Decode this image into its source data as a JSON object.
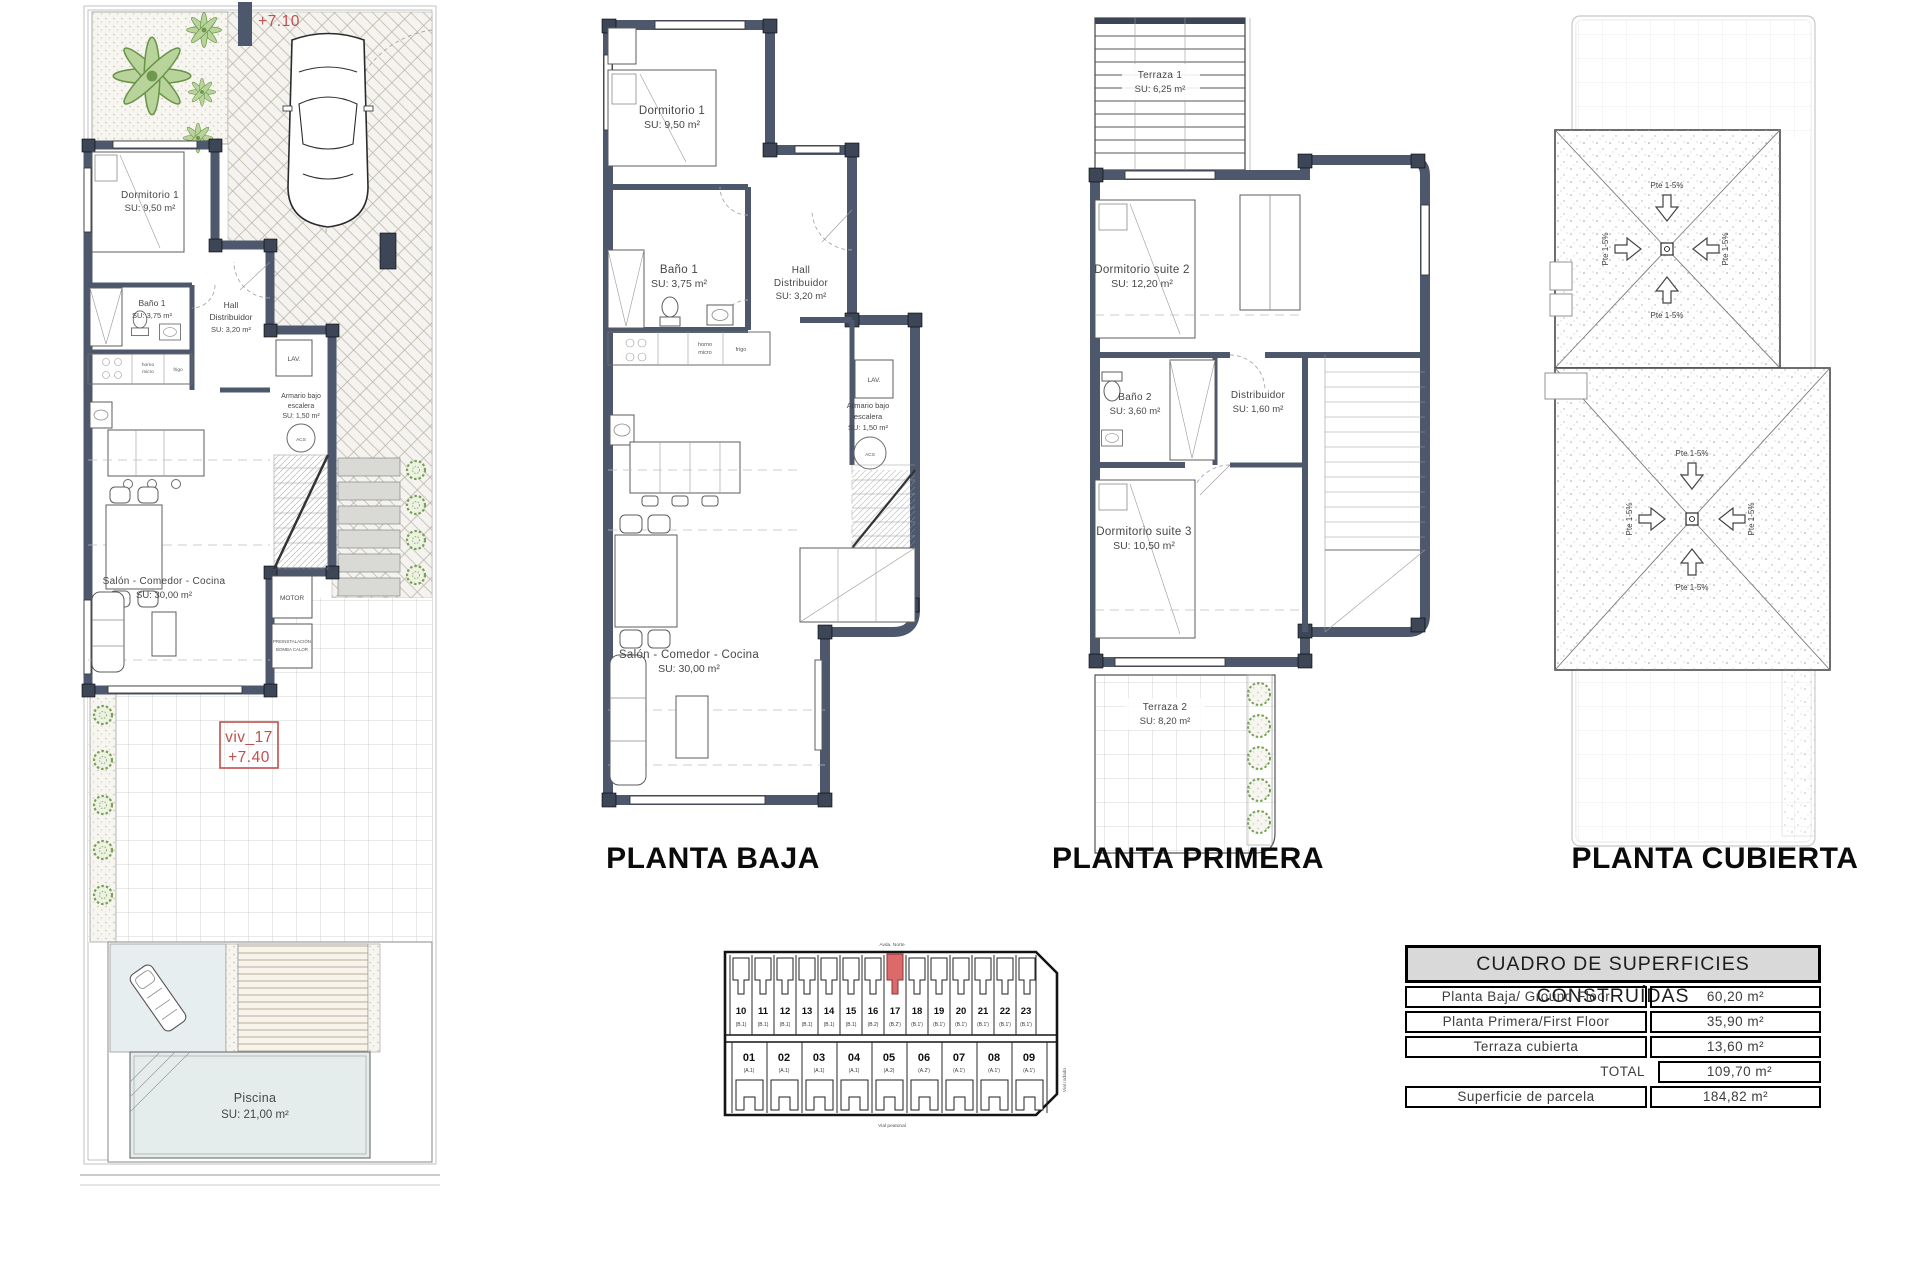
{
  "colors": {
    "wall": "#4d586c",
    "accent_red": "#c0504d",
    "unit_highlight": "#dd6a6a",
    "pool": "#e4ecec",
    "green": "#7aa05a"
  },
  "site_plan": {
    "level_top": "+7.10",
    "unit_id": "viv_17",
    "unit_level": "+7.40",
    "dormitorio1": {
      "line1": "Dormitorio 1",
      "area": "SU: 9,50 m²"
    },
    "bano1": {
      "line1": "Baño 1",
      "area": "SU: 3,75 m²"
    },
    "hall": {
      "line1": "Hall",
      "line2": "Distribuidor",
      "area": "SU: 3,20 m²"
    },
    "armario": {
      "line1": "Armario bajo",
      "line2": "escalera",
      "area": "SU: 1,50 m²"
    },
    "salon": {
      "line1": "Salón - Comedor - Cocina",
      "area": "SU: 30,00 m²"
    },
    "piscina": {
      "line1": "Piscina",
      "area": "SU: 21,00 m²"
    },
    "motor": "MOTOR",
    "preinst1": "PREINSTALACIÓN",
    "preinst2": "BOMBA CALOR",
    "horno1": "horno",
    "horno2": "micro",
    "frigo": "frigo",
    "lav": "LAV.",
    "acs": "ACS"
  },
  "planta_baja": {
    "title": "PLANTA BAJA",
    "dormitorio1": {
      "line1": "Dormitorio 1",
      "area": "SU: 9,50 m²"
    },
    "bano1": {
      "line1": "Baño 1",
      "area": "SU: 3,75 m²"
    },
    "hall": {
      "line1": "Hall",
      "line2": "Distribuidor",
      "area": "SU: 3,20 m²"
    },
    "armario": {
      "line1": "Armario bajo",
      "line2": "escalera",
      "area": "SU: 1,50 m²"
    },
    "salon": {
      "line1": "Salón - Comedor - Cocina",
      "area": "SU: 30,00 m²"
    },
    "horno1": "horno",
    "horno2": "micro",
    "frigo": "frigo",
    "lav": "LAV.",
    "acs": "ACS"
  },
  "planta_primera": {
    "title": "PLANTA PRIMERA",
    "terraza1": {
      "line1": "Terraza 1",
      "area": "SU: 6,25 m²"
    },
    "suite2": {
      "line1": "Dormitorio suite 2",
      "area": "SU: 12,20 m²"
    },
    "bano2": {
      "line1": "Baño 2",
      "area": "SU: 3,60 m²"
    },
    "distribuidor": {
      "line1": "Distribuidor",
      "area": "SU: 1,60 m²"
    },
    "suite3": {
      "line1": "Dormitorio suite 3",
      "area": "SU: 10,50 m²"
    },
    "terraza2": {
      "line1": "Terraza 2",
      "area": "SU: 8,20 m²"
    }
  },
  "planta_cubierta": {
    "title": "PLANTA CUBIERTA",
    "slope": "Pte 1-5%"
  },
  "key_plan": {
    "street_top": "Avda. Norte",
    "street_bottom": "Vial peatonal",
    "street_right": "Vial rodado",
    "highlighted_unit": "17",
    "top_row": [
      {
        "num": "10",
        "type": "(B.1)"
      },
      {
        "num": "11",
        "type": "(B.1)"
      },
      {
        "num": "12",
        "type": "(B.1)"
      },
      {
        "num": "13",
        "type": "(B.1)"
      },
      {
        "num": "14",
        "type": "(B.1)"
      },
      {
        "num": "15",
        "type": "(B.1)"
      },
      {
        "num": "16",
        "type": "(B.2)"
      },
      {
        "num": "17",
        "type": "(B.2')"
      },
      {
        "num": "18",
        "type": "(B.1')"
      },
      {
        "num": "19",
        "type": "(B.1')"
      },
      {
        "num": "20",
        "type": "(B.1')"
      },
      {
        "num": "21",
        "type": "(B.1')"
      },
      {
        "num": "22",
        "type": "(B.1')"
      },
      {
        "num": "23",
        "type": "(B.1')"
      }
    ],
    "bottom_row": [
      {
        "num": "01",
        "type": "(A.1)"
      },
      {
        "num": "02",
        "type": "(A.1)"
      },
      {
        "num": "03",
        "type": "(A.1)"
      },
      {
        "num": "04",
        "type": "(A.1)"
      },
      {
        "num": "05",
        "type": "(A.2)"
      },
      {
        "num": "06",
        "type": "(A.2')"
      },
      {
        "num": "07",
        "type": "(A.1')"
      },
      {
        "num": "08",
        "type": "(A.1')"
      },
      {
        "num": "09",
        "type": "(A.1')"
      }
    ]
  },
  "areas_table": {
    "title": "CUADRO DE SUPERFICIES CONSTRUÍDAS",
    "rows": [
      {
        "label": "Planta Baja/ Ground Floor",
        "value": "60,20 m²"
      },
      {
        "label": "Planta Primera/First Floor",
        "value": "35,90 m²"
      },
      {
        "label": "Terraza cubierta",
        "value": "13,60 m²"
      },
      {
        "label": "TOTAL",
        "value": "109,70 m²"
      },
      {
        "label": "Superficie de parcela",
        "value": "184,82 m²"
      }
    ]
  }
}
